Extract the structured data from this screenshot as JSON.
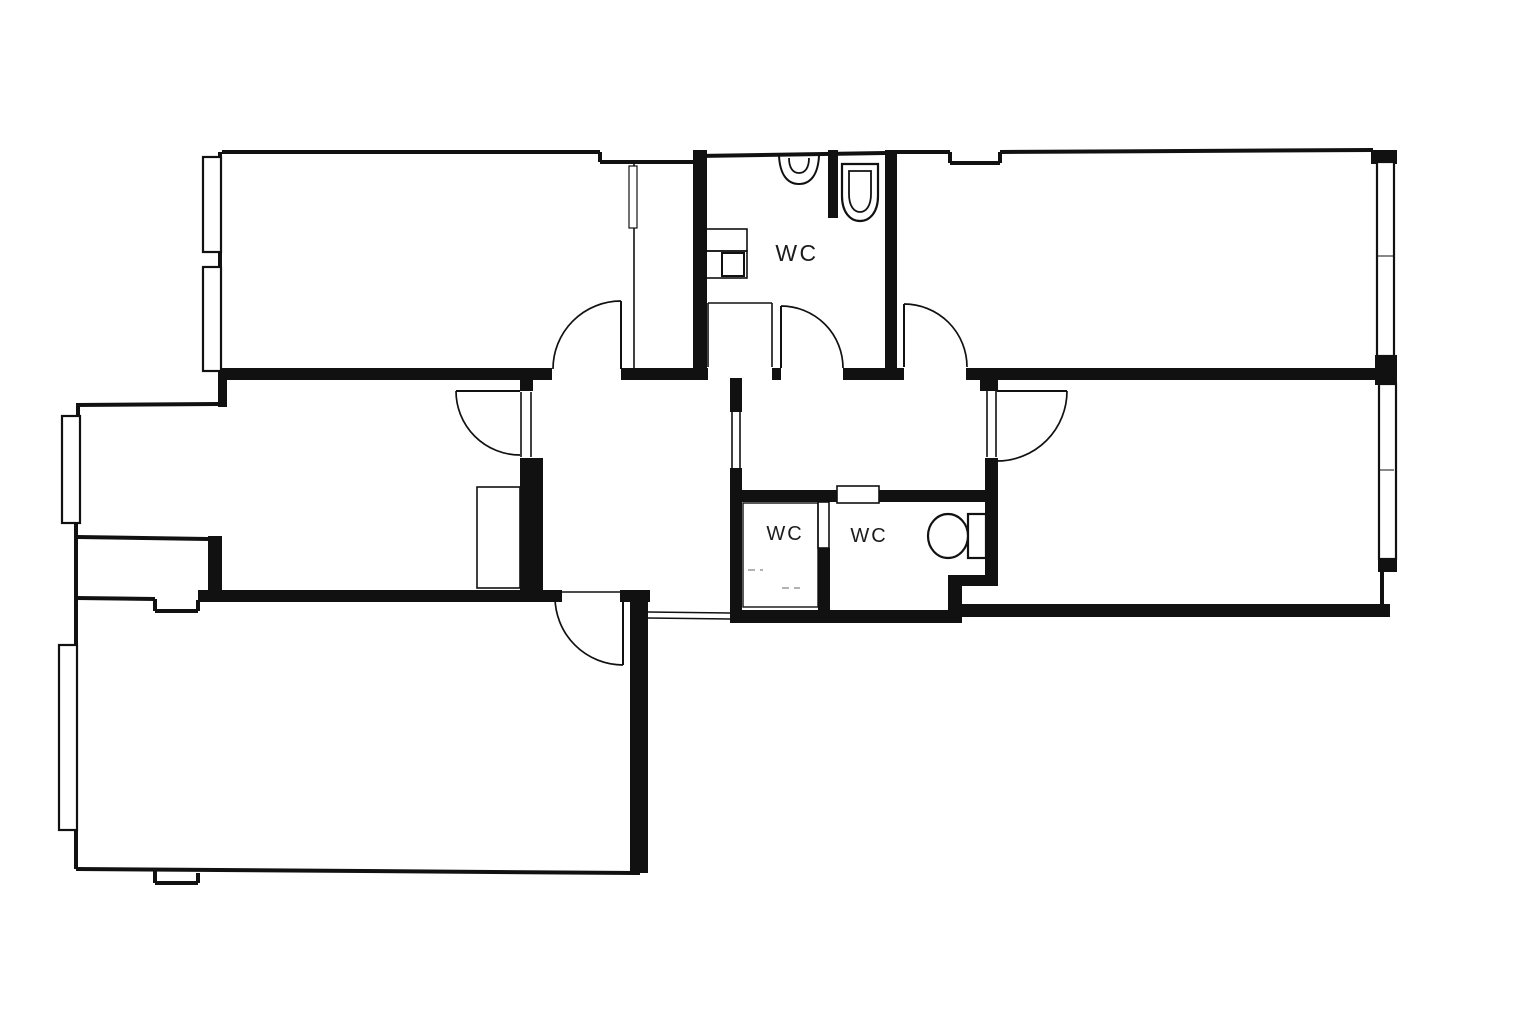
{
  "canvas": {
    "width": 1536,
    "height": 1024,
    "background": "#ffffff",
    "ink": "#111111",
    "dash_color": "#9a9a9a"
  },
  "labels": [
    {
      "text": "WC",
      "x": 797,
      "y": 261,
      "size": 23,
      "spacing": 2.5
    },
    {
      "text": "WC",
      "x": 785,
      "y": 540,
      "size": 20,
      "spacing": 2
    },
    {
      "text": "WC",
      "x": 869,
      "y": 542,
      "size": 20,
      "spacing": 2
    }
  ],
  "geometry": {
    "thick_walls": [
      [
        218,
        368,
        334,
        12
      ],
      [
        621,
        368,
        17,
        12
      ],
      [
        638,
        368,
        70,
        12
      ],
      [
        772,
        368,
        9,
        12
      ],
      [
        843,
        368,
        61,
        12
      ],
      [
        966,
        368,
        411,
        12
      ],
      [
        980,
        378,
        18,
        13
      ],
      [
        520,
        371,
        13,
        20
      ],
      [
        520,
        458,
        23,
        132
      ],
      [
        208,
        536,
        14,
        56
      ],
      [
        198,
        590,
        364,
        12
      ],
      [
        620,
        590,
        30,
        12
      ],
      [
        630,
        597,
        18,
        276
      ],
      [
        730,
        378,
        12,
        34
      ],
      [
        730,
        468,
        12,
        155
      ],
      [
        742,
        490,
        96,
        12
      ],
      [
        878,
        490,
        120,
        12
      ],
      [
        818,
        548,
        12,
        65
      ],
      [
        730,
        610,
        232,
        13
      ],
      [
        948,
        575,
        14,
        48
      ],
      [
        948,
        575,
        50,
        11
      ],
      [
        985,
        458,
        13,
        122
      ],
      [
        962,
        604,
        428,
        13
      ],
      [
        885,
        150,
        12,
        218
      ],
      [
        828,
        150,
        10,
        68
      ],
      [
        693,
        150,
        14,
        218
      ],
      [
        1373,
        150,
        24,
        14
      ],
      [
        1375,
        355,
        22,
        30
      ],
      [
        1378,
        558,
        19,
        14
      ],
      [
        218,
        368,
        9,
        39
      ]
    ],
    "outline_walls": [
      [
        222,
        152,
        600,
        152
      ],
      [
        600,
        152,
        600,
        162
      ],
      [
        600,
        162,
        697,
        162
      ],
      [
        220,
        152,
        220,
        160
      ],
      [
        220,
        250,
        220,
        270
      ],
      [
        697,
        156,
        885,
        153
      ],
      [
        897,
        152,
        950,
        152
      ],
      [
        950,
        152,
        950,
        163
      ],
      [
        950,
        163,
        1000,
        163
      ],
      [
        1000,
        163,
        1000,
        152
      ],
      [
        1000,
        152,
        1373,
        150
      ],
      [
        1373,
        150,
        1373,
        164
      ],
      [
        76,
        405,
        218,
        404
      ],
      [
        78,
        404,
        78,
        417
      ],
      [
        76,
        522,
        76,
        598
      ],
      [
        77,
        537,
        208,
        539
      ],
      [
        76,
        598,
        155,
        599
      ],
      [
        155,
        599,
        155,
        611
      ],
      [
        155,
        611,
        198,
        611
      ],
      [
        198,
        611,
        198,
        600
      ],
      [
        76,
        598,
        76,
        647
      ],
      [
        76,
        829,
        76,
        869
      ],
      [
        76,
        869,
        640,
        873
      ],
      [
        155,
        871,
        155,
        883
      ],
      [
        155,
        883,
        198,
        883
      ],
      [
        198,
        883,
        198,
        873
      ],
      [
        1382,
        572,
        1382,
        606
      ]
    ],
    "partition_lines": [
      [
        521,
        392,
        521,
        457
      ],
      [
        531,
        392,
        531,
        457
      ],
      [
        987,
        391,
        987,
        457
      ],
      [
        996,
        391,
        996,
        457
      ],
      [
        732,
        412,
        732,
        468
      ],
      [
        740,
        412,
        740,
        468
      ],
      [
        648,
        612,
        730,
        613
      ],
      [
        648,
        618,
        730,
        619
      ],
      [
        562,
        592,
        621,
        592
      ],
      [
        708,
        303,
        708,
        367
      ],
      [
        708,
        303,
        772,
        303
      ],
      [
        772,
        303,
        772,
        367
      ],
      [
        634,
        162,
        634,
        372
      ]
    ],
    "windows": [
      [
        203,
        157,
        18,
        95
      ],
      [
        203,
        267,
        18,
        104
      ],
      [
        62,
        416,
        18,
        107
      ],
      [
        59,
        645,
        18,
        185
      ],
      [
        1377,
        162,
        17,
        194
      ],
      [
        1379,
        384,
        17,
        175
      ]
    ],
    "window_ticks": [
      [
        1378,
        256,
        1393,
        256
      ],
      [
        1380,
        470,
        1394,
        470
      ]
    ],
    "doors": [
      {
        "name": "door-top-left-room",
        "leaf": [
          621,
          369,
          621,
          301
        ],
        "arc": "M 553 369 A 68 68 0 0 1 621 301"
      },
      {
        "name": "door-wc-top",
        "leaf": [
          781,
          368,
          781,
          306
        ],
        "arc": "M 781 306 A 62 62 0 0 1 843 368"
      },
      {
        "name": "door-top-right-room",
        "leaf": [
          904,
          367,
          904,
          304
        ],
        "arc": "M 904 304 A 63 63 0 0 1 967 367"
      },
      {
        "name": "door-middle-left-room",
        "leaf": [
          456,
          391,
          520,
          391
        ],
        "arc": "M 456 391 A 64 64 0 0 0 520 455"
      },
      {
        "name": "door-right-room",
        "leaf": [
          997,
          391,
          1067,
          391
        ],
        "arc": "M 1067 391 A 70 70 0 0 1 997 461"
      },
      {
        "name": "door-bottom-left-room",
        "leaf": [
          623,
          597,
          623,
          665
        ],
        "arc": "M 555 597 A 68 68 0 0 0 623 665"
      }
    ],
    "white_rects": [
      {
        "name": "closet-outline",
        "x": 477,
        "y": 487,
        "w": 43,
        "h": 101,
        "stroke": 1.6,
        "fill": "none"
      },
      {
        "name": "wc-door-leaf",
        "x": 818,
        "y": 502,
        "w": 11,
        "h": 46,
        "stroke": 1.6,
        "fill": "#ffffff"
      },
      {
        "name": "wc-door-recess",
        "x": 837,
        "y": 486,
        "w": 42,
        "h": 17,
        "stroke": 1.6,
        "fill": "#ffffff"
      },
      {
        "name": "closet-door-jamb",
        "x": 629,
        "y": 166,
        "w": 8,
        "h": 62,
        "stroke": 1.2,
        "fill": "#ffffff"
      },
      {
        "name": "wc-interior-outline",
        "x": 743,
        "y": 503,
        "w": 75,
        "h": 104,
        "stroke": 1.4,
        "fill": "none"
      },
      {
        "name": "cabinet-top",
        "x": 705,
        "y": 229,
        "w": 42,
        "h": 22,
        "stroke": 1.6,
        "fill": "none"
      },
      {
        "name": "cabinet-bottom",
        "x": 705,
        "y": 251,
        "w": 42,
        "h": 27,
        "stroke": 1.6,
        "fill": "none"
      },
      {
        "name": "washer",
        "x": 722,
        "y": 253,
        "w": 22,
        "h": 23,
        "stroke": 2,
        "fill": "#ffffff"
      },
      {
        "name": "toilet-tank",
        "x": 968,
        "y": 514,
        "w": 18,
        "h": 44,
        "stroke": 2.2,
        "fill": "#ffffff"
      }
    ],
    "fixture_paths": [
      {
        "name": "sink-basin-outer",
        "d": "M 779 156 C 780 174 787 184 799 184 C 811 184 818 174 819 156",
        "stroke": 2,
        "fill": "none"
      },
      {
        "name": "sink-basin-inner",
        "d": "M 789 158 C 789 168 793 173 799 173 C 805 173 809 168 809 158",
        "stroke": 1.8,
        "fill": "none"
      },
      {
        "name": "toilet-top-outer",
        "d": "M 842 164 L 878 164 L 878 196 C 878 212 870 221 860 221 C 850 221 842 212 842 196 Z",
        "stroke": 2.2,
        "fill": "#ffffff"
      },
      {
        "name": "toilet-top-bowl",
        "d": "M 849 171 L 871 171 L 871 194 C 871 206 866 212 860 212 C 854 212 849 206 849 194 Z",
        "stroke": 1.8,
        "fill": "none"
      }
    ],
    "ellipses": [
      {
        "name": "toilet-right-bowl",
        "cx": 948,
        "cy": 536,
        "rx": 20,
        "ry": 22,
        "stroke": 2.2,
        "fill": "#ffffff"
      }
    ],
    "dashed_lines": [
      [
        748,
        570,
        763,
        570
      ],
      [
        782,
        588,
        800,
        588
      ]
    ]
  }
}
